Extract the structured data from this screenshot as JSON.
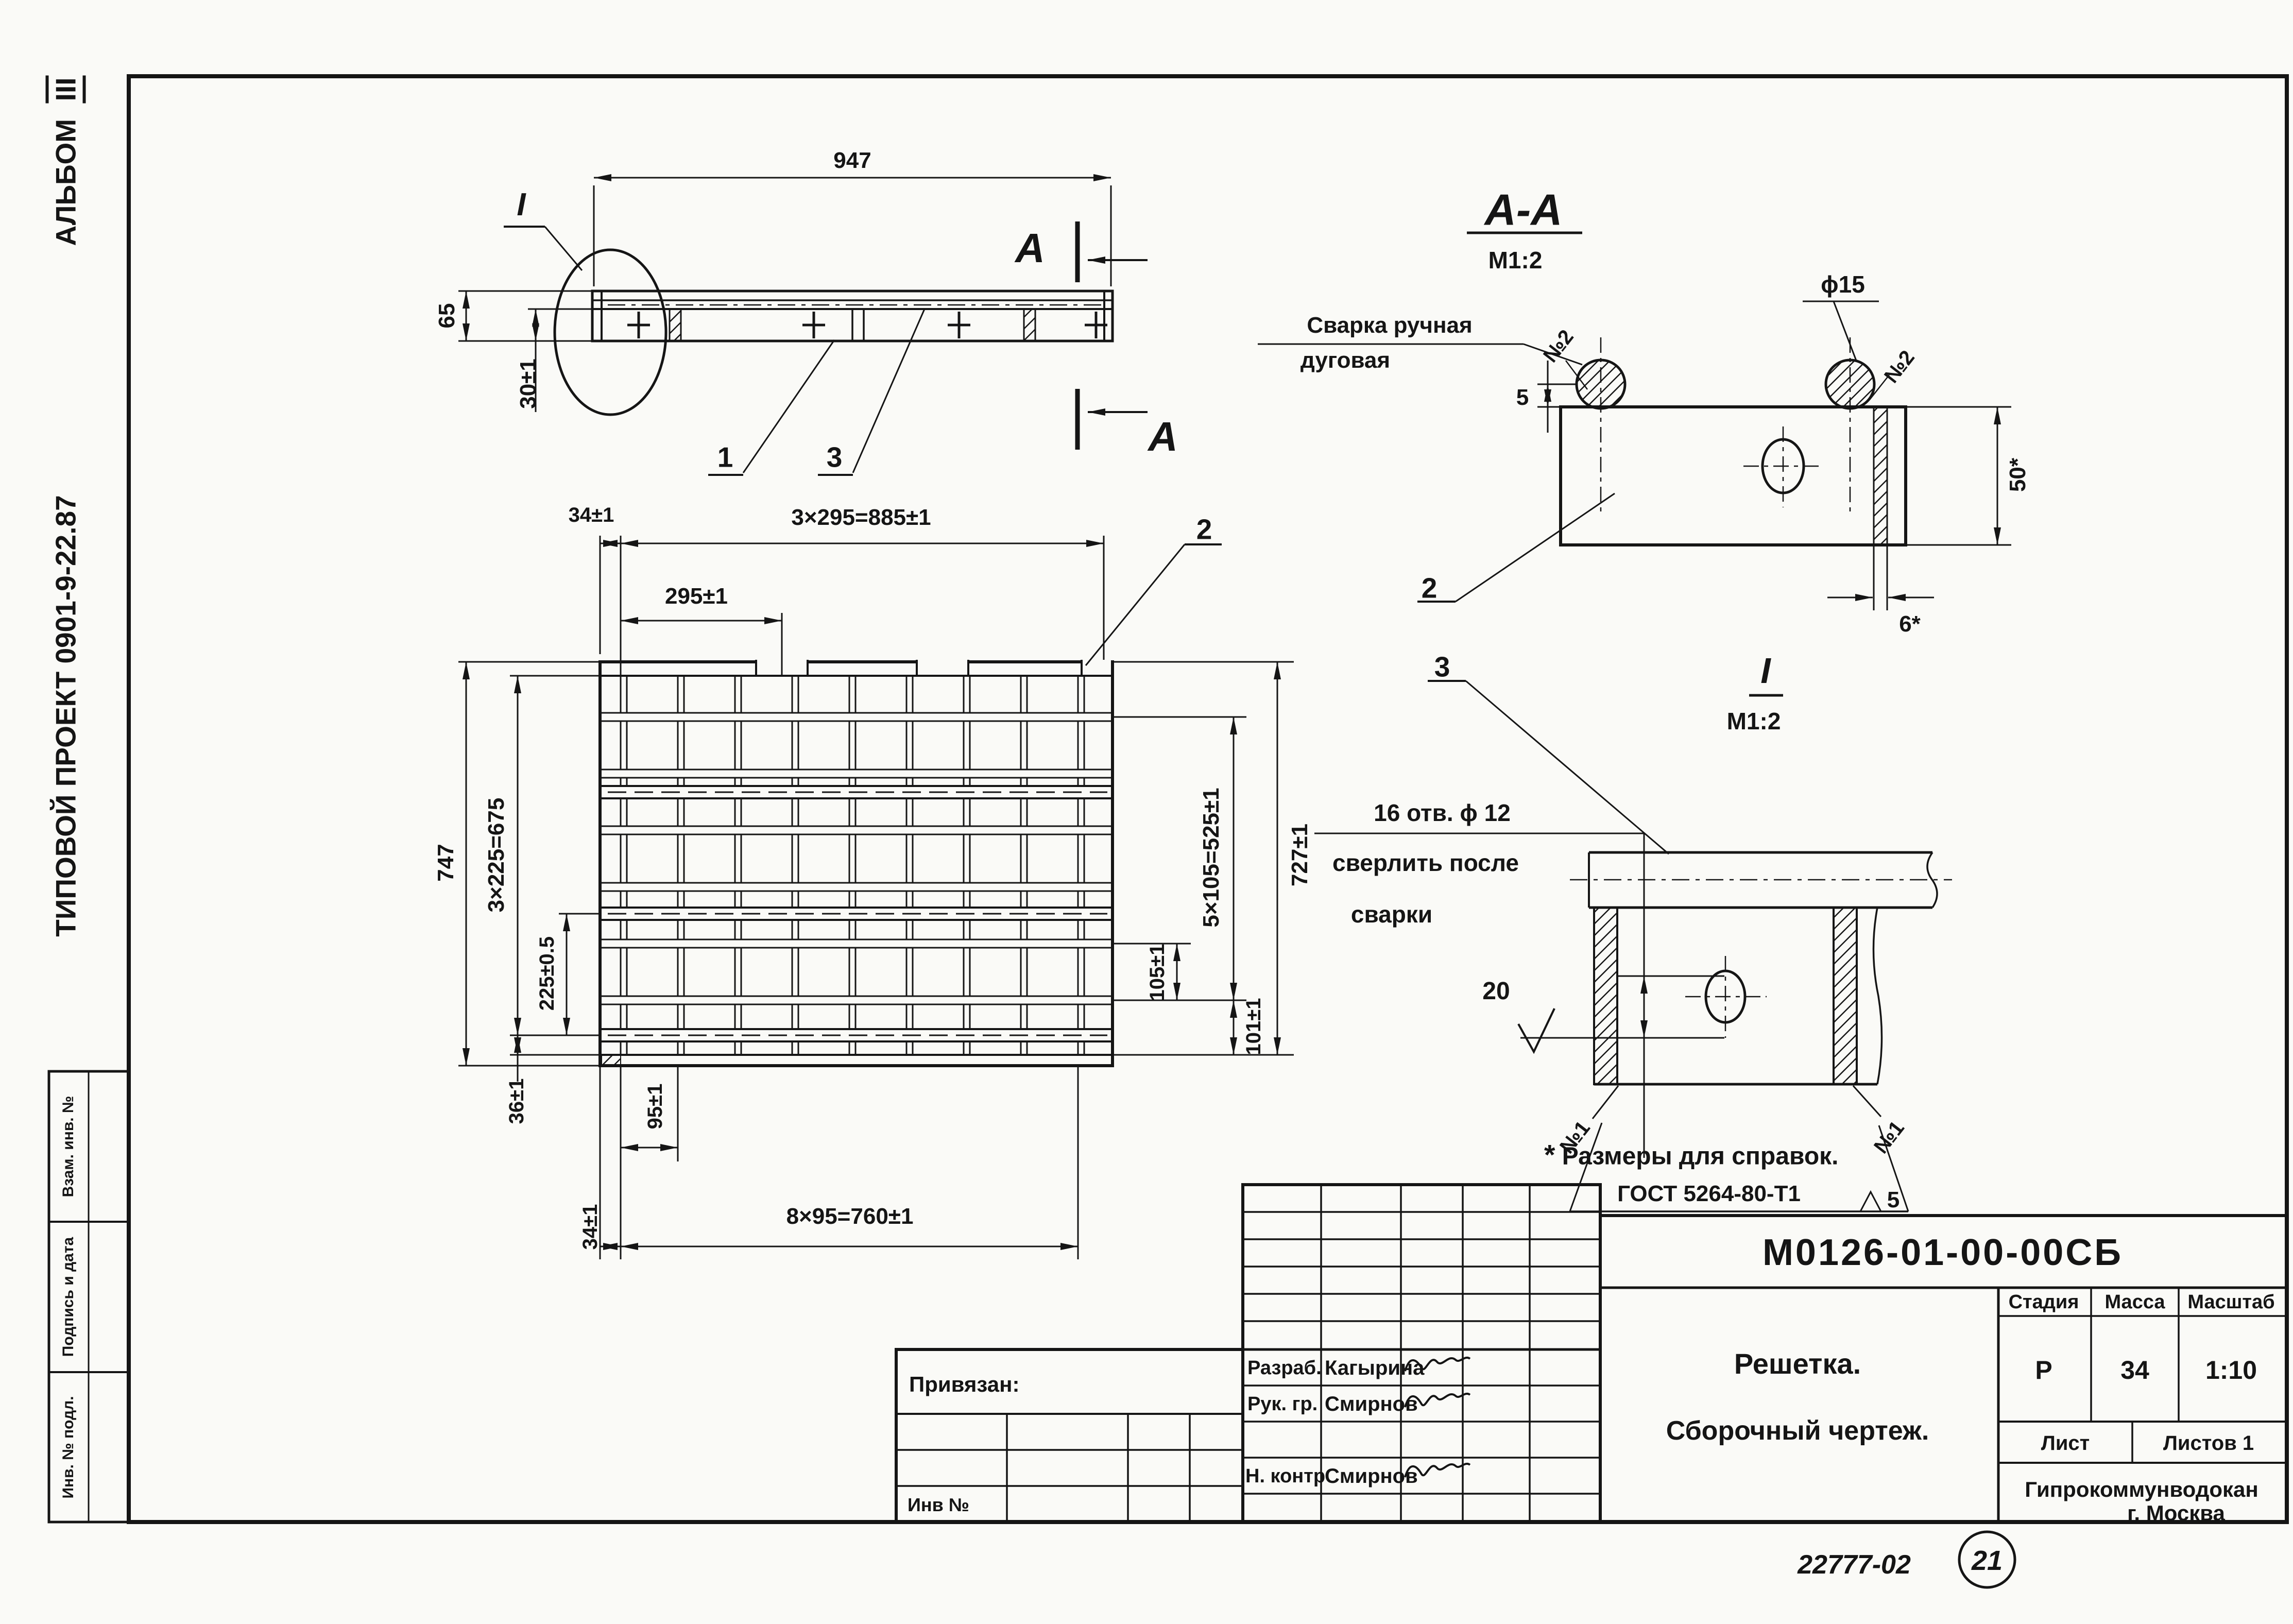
{
  "margin": {
    "album_label": "АЛЬБОМ",
    "album_number": "III",
    "project": "ТИПОВОЙ ПРОЕКТ 0901-9-22.87",
    "stamp": {
      "r1": "Взам. инв. №",
      "r2": "Подпись и дата",
      "r3": "Инв. № подл."
    }
  },
  "top_view": {
    "dim_length": "947",
    "dim_height": "65",
    "dim_lower": "30±1",
    "detail_label": "I",
    "section_letter": "А",
    "item1": "1",
    "item3": "3"
  },
  "plan": {
    "dim_margin_top": "34±1",
    "dim_3x295": "3×295=885±1",
    "dim_295": "295±1",
    "item2": "2",
    "dim_5x105": "5×105=525±1",
    "dim_105": "105±1",
    "dim_101": "101±1",
    "dim_727": "727±1",
    "dim_747": "747",
    "dim_3x225": "3×225=675",
    "dim_225": "225±0.5",
    "dim_36": "36±1",
    "dim_95": "95±1",
    "dim_margin_bottom": "34±1",
    "dim_8x95": "8×95=760±1"
  },
  "section_aa": {
    "title": "А-А",
    "scale": "М1:2",
    "weld_note1": "Сварка ручная",
    "weld_note2": "дуговая",
    "weld_no": "№2",
    "dia": "ϕ15",
    "dim_5": "5",
    "dim_50": "50*",
    "dim_6": "6*",
    "item2": "2"
  },
  "detail_i": {
    "title": "I",
    "scale": "М1:2",
    "item3": "3",
    "holes1": "16 отв. ϕ 12",
    "holes2": "сверлить после",
    "holes3": "сварки",
    "dim_20": "20",
    "weld_no": "№1",
    "gost": "ГОСТ 5264-80-Т1",
    "gost_size": "5"
  },
  "note": {
    "star": "*",
    "text": "Размеры для  справок."
  },
  "tb": {
    "doc_number": "М0126-01-00-00СБ",
    "name1": "Решетка.",
    "name2": "Сборочный чертеж.",
    "stage_label": "Стадия",
    "mass_label": "Масса",
    "scale_label": "Масштаб",
    "stage": "Р",
    "mass": "34",
    "scale": "1:10",
    "sheet_label": "Лист",
    "sheets_label": "Листов 1",
    "org1": "Гипрокоммунводокан",
    "org2": "г. Москва",
    "attach": "Привязан:",
    "inv": "Инв №",
    "role1": "Разраб.",
    "name_role1": "Кагырина",
    "role2": "Рук. гр.",
    "name_role2": "Смирнов",
    "role3": "Н. контр",
    "name_role3": "Смирнов"
  },
  "footer": {
    "doc": "22777-02",
    "page": "21"
  }
}
